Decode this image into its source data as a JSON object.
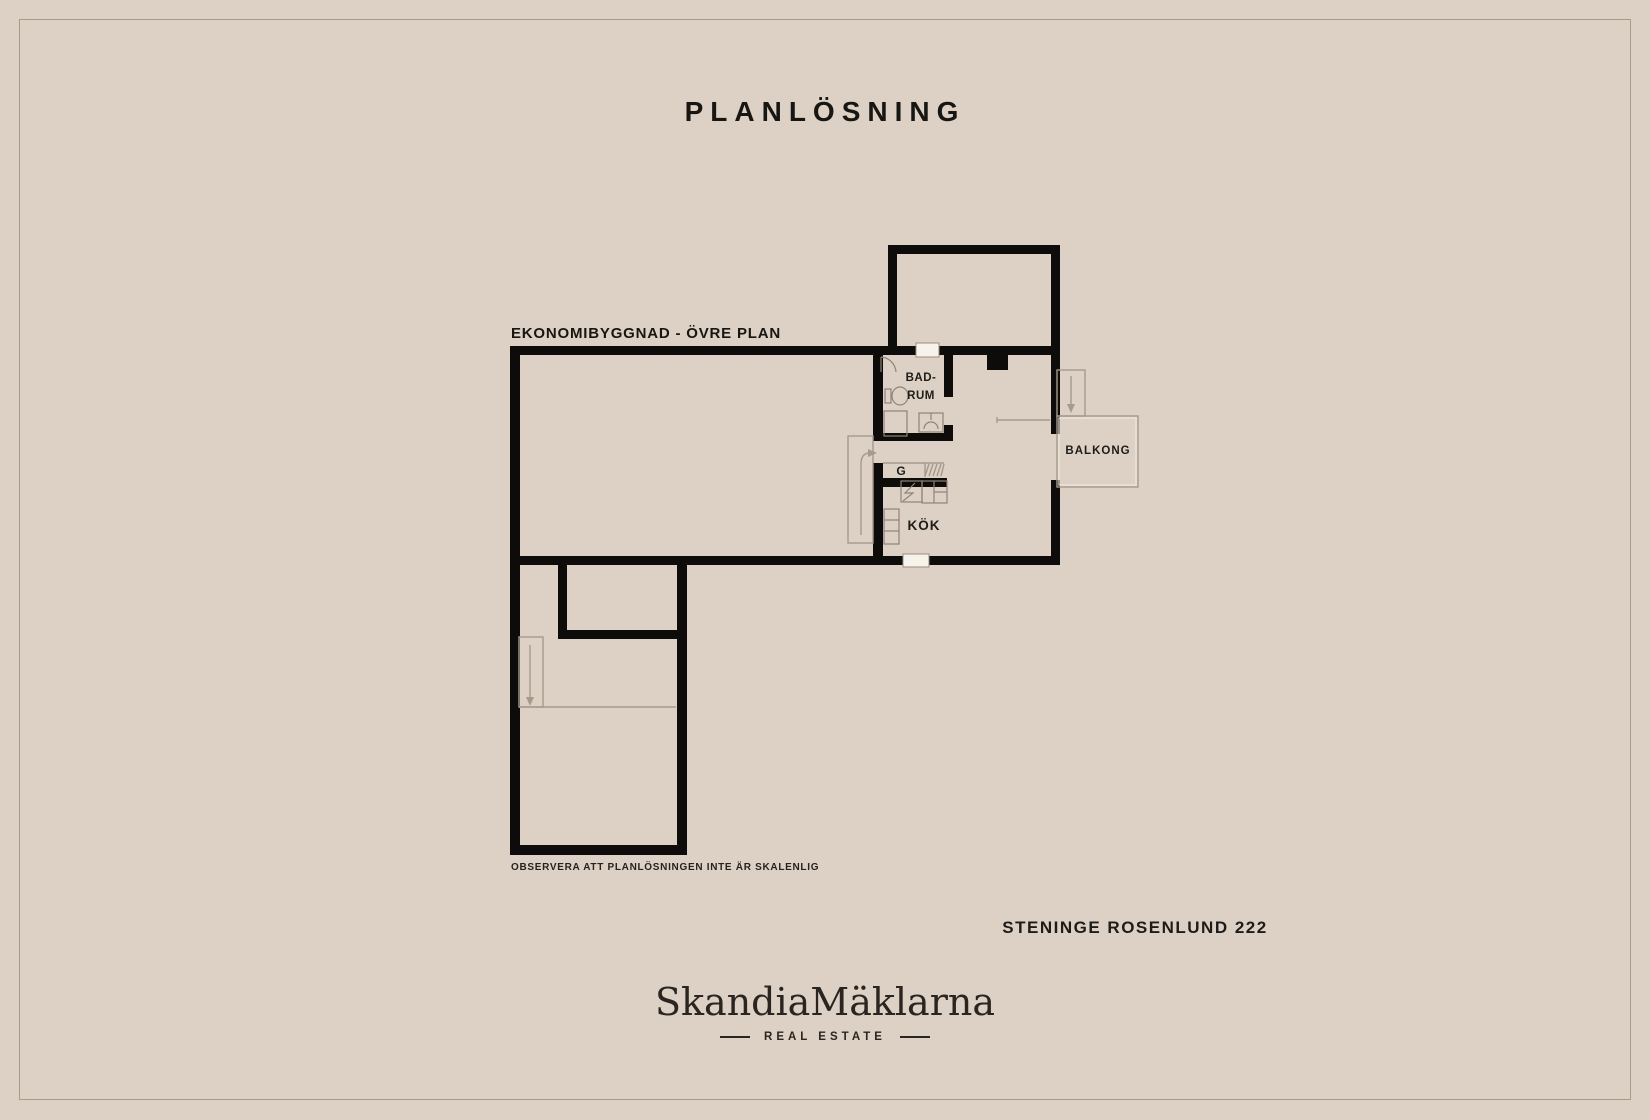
{
  "page": {
    "title": "PLANLÖSNING",
    "background_color": "#ddd1c5",
    "frame_border_color": "#8f7e68",
    "wall_color": "#0d0c0a",
    "text_color": "#1e1c19",
    "faint_line_color": "#a59a8c"
  },
  "plan": {
    "label": "EKONOMIBYGGNAD - ÖVRE PLAN",
    "note": "OBSERVERA ATT PLANLÖSNINGEN INTE ÄR SKALENLIG",
    "rooms": {
      "bathroom_line1": "BAD-",
      "bathroom_line2": "RUM",
      "closet": "G",
      "kitchen": "KÖK",
      "balcony": "BALKONG"
    }
  },
  "footer": {
    "address": "STENINGE ROSENLUND 222",
    "brand": "SkandiaMäklarna",
    "brand_tagline": "REAL ESTATE"
  }
}
